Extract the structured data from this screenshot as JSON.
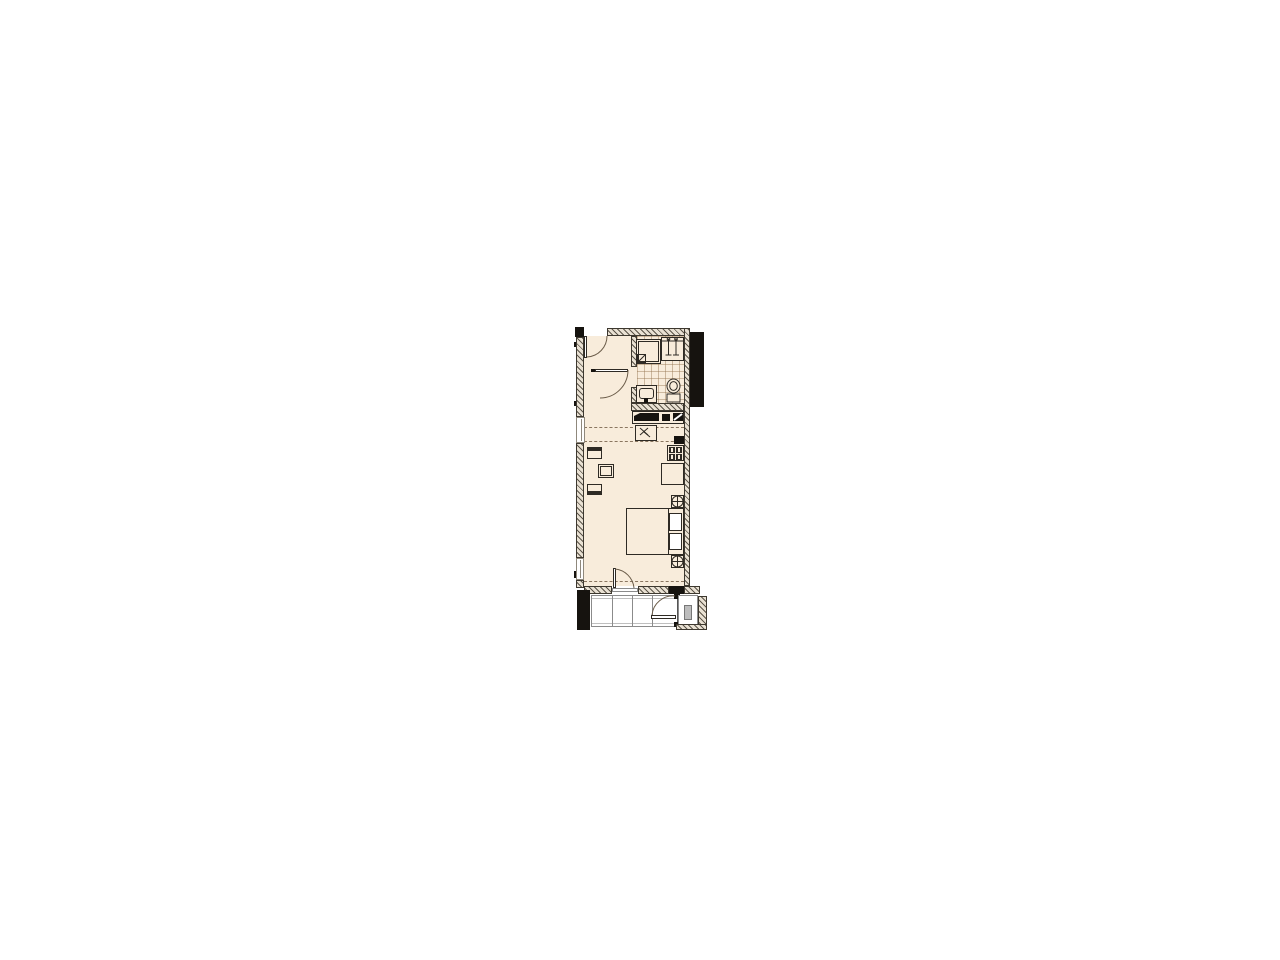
{
  "meta": {
    "title": "Studio apartment floor plan",
    "type": "floor-plan",
    "visible_text": ""
  },
  "palette": {
    "floor": "#f8ecdb",
    "tile-line": "rgba(150,118,82,0.45)",
    "wall-base": "#e9e1d3",
    "wall-stripe": "#5c554a",
    "wall-edge": "#3d382f",
    "ink": "#2e2a24",
    "black": "#16130f",
    "dash": "#8a7660",
    "arc": "#6b5c49",
    "balcony-line": "#8b8b8b",
    "gray-box": "#bdbdbd",
    "window-edge": "#8f887c"
  },
  "rooms": [
    {
      "name": "entrance-hall"
    },
    {
      "name": "bathroom"
    },
    {
      "name": "living-room-with-kitchenette"
    },
    {
      "name": "balcony"
    }
  ],
  "legend": {
    "entrance-door": "entry door with quarter-circle swing",
    "interior-door": "hall door with swing arc",
    "shower": "shower enclosure with drain square",
    "wardrobe": "wardrobe with clothes rail and hangers",
    "washbasin": "washbasin with tap",
    "toilet": "toilet with cistern",
    "service-duct": "dark service/kitchen duct band",
    "sink-unit": "kitchen sink unit with tap symbol",
    "cooktop": "four-burner cooktop",
    "kitchen-counter": "kitchen counter",
    "dining-table": "small dining table",
    "chair": "dining chair",
    "double-bed": "double bed with two pillows",
    "circle-cross-symbol": "circled cross fixture symbol",
    "balcony-door": "balcony door with swing arc",
    "balcony-railing": "balcony railing panels",
    "utility-box": "gray utility box on balcony"
  }
}
